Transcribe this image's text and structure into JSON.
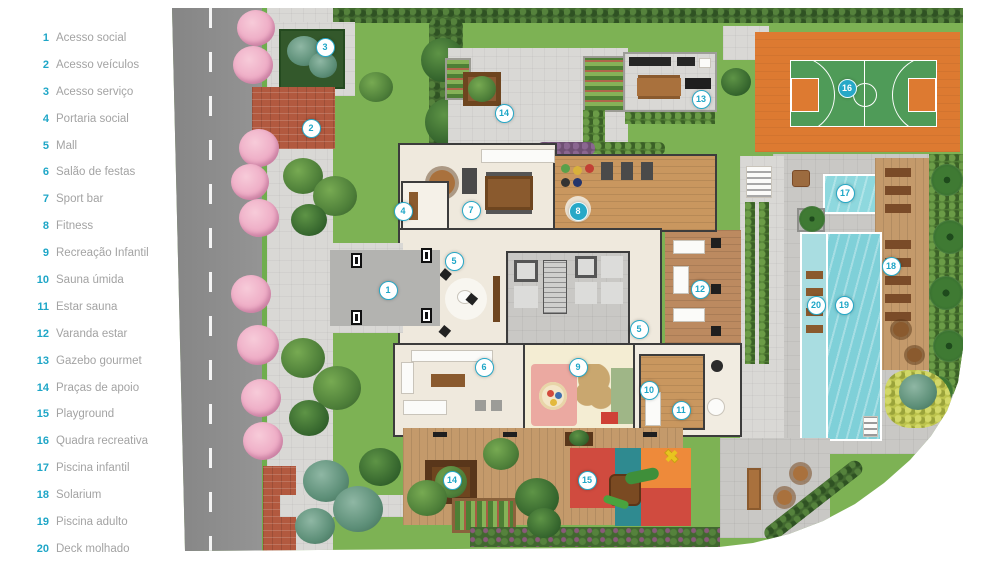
{
  "legend": {
    "items": [
      {
        "number": "1",
        "label": "Acesso social"
      },
      {
        "number": "2",
        "label": "Acesso veículos"
      },
      {
        "number": "3",
        "label": "Acesso serviço"
      },
      {
        "number": "4",
        "label": "Portaria social"
      },
      {
        "number": "5",
        "label": "Mall"
      },
      {
        "number": "6",
        "label": "Salão de festas"
      },
      {
        "number": "7",
        "label": "Sport bar"
      },
      {
        "number": "8",
        "label": "Fitness"
      },
      {
        "number": "9",
        "label": "Recreação Infantil"
      },
      {
        "number": "10",
        "label": "Sauna úmida"
      },
      {
        "number": "11",
        "label": "Estar sauna"
      },
      {
        "number": "12",
        "label": "Varanda estar"
      },
      {
        "number": "13",
        "label": "Gazebo gourmet"
      },
      {
        "number": "14",
        "label": "Praças de apoio"
      },
      {
        "number": "15",
        "label": "Playground"
      },
      {
        "number": "16",
        "label": "Quadra recreativa"
      },
      {
        "number": "17",
        "label": "Piscina infantil"
      },
      {
        "number": "18",
        "label": "Solarium"
      },
      {
        "number": "19",
        "label": "Piscina adulto"
      },
      {
        "number": "20",
        "label": "Deck molhado"
      }
    ]
  },
  "plan": {
    "markers": [
      {
        "n": "1",
        "x": 224,
        "y": 281,
        "variant": "light"
      },
      {
        "n": "2",
        "x": 147,
        "y": 119,
        "variant": "light"
      },
      {
        "n": "3",
        "x": 161,
        "y": 38,
        "variant": "light"
      },
      {
        "n": "4",
        "x": 239,
        "y": 202,
        "variant": "light"
      },
      {
        "n": "5",
        "x": 290,
        "y": 252,
        "variant": "light"
      },
      {
        "n": "5",
        "x": 475,
        "y": 320,
        "variant": "light"
      },
      {
        "n": "6",
        "x": 320,
        "y": 358,
        "variant": "light"
      },
      {
        "n": "7",
        "x": 307,
        "y": 201,
        "variant": "light"
      },
      {
        "n": "8",
        "x": 414,
        "y": 202,
        "variant": "solid"
      },
      {
        "n": "9",
        "x": 414,
        "y": 358,
        "variant": "light"
      },
      {
        "n": "10",
        "x": 485,
        "y": 381,
        "variant": "light"
      },
      {
        "n": "11",
        "x": 517,
        "y": 401,
        "variant": "light"
      },
      {
        "n": "12",
        "x": 536,
        "y": 280,
        "variant": "light"
      },
      {
        "n": "13",
        "x": 537,
        "y": 90,
        "variant": "light"
      },
      {
        "n": "14",
        "x": 340,
        "y": 104,
        "variant": "light"
      },
      {
        "n": "14",
        "x": 288,
        "y": 471,
        "variant": "light"
      },
      {
        "n": "15",
        "x": 423,
        "y": 471,
        "variant": "light"
      },
      {
        "n": "16",
        "x": 683,
        "y": 79,
        "variant": "solid"
      },
      {
        "n": "17",
        "x": 681,
        "y": 184,
        "variant": "light"
      },
      {
        "n": "18",
        "x": 727,
        "y": 257,
        "variant": "light"
      },
      {
        "n": "19",
        "x": 680,
        "y": 296,
        "variant": "light"
      },
      {
        "n": "20",
        "x": 652,
        "y": 296,
        "variant": "light"
      }
    ],
    "colors": {
      "accent_cyan": "#1ea6c7",
      "legend_text": "#a3a3a3",
      "road_gray": "#8f8f8f",
      "sidewalk_gray": "#d9d8d5",
      "grass_green": "#7db254",
      "hedge_green": "#41682f",
      "brick_red": "#b2593f",
      "wood_deck": "#c49a6b",
      "pool_blue": "#7fd0d8",
      "wet_deck_blue": "#a9dde1",
      "court_orange": "#dd7a31",
      "court_green": "#4f9b58",
      "building_floor": "#efe9dd",
      "playground_red": "#d04b3f",
      "playground_teal": "#2f8a90",
      "playground_orange": "#ee8a3a"
    }
  }
}
